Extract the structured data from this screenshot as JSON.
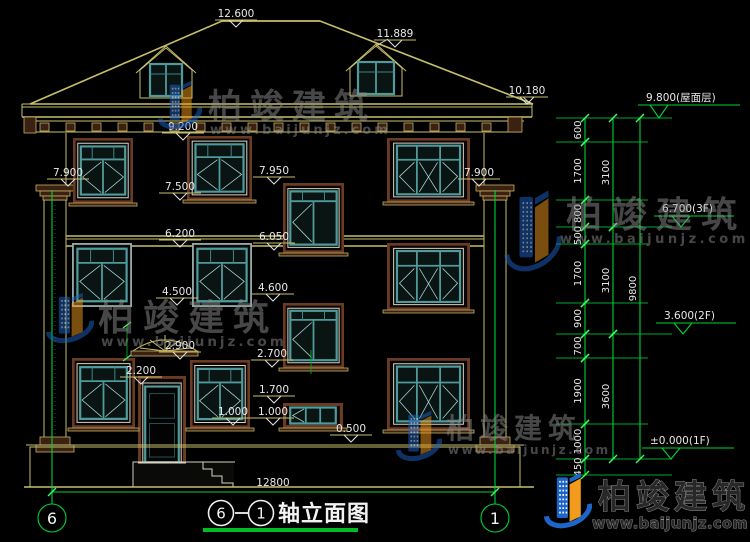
{
  "watermark": {
    "brand": "柏竣建筑",
    "url": "www.baijunjz.com"
  },
  "footer": {
    "brand": "柏竣建筑",
    "url": "www.baijunjz.com"
  },
  "title_block": {
    "from": "6",
    "to": "1",
    "title": "轴立面图"
  },
  "axes": {
    "left": "6",
    "right": "1"
  },
  "dims": {
    "total_width": "12800",
    "inner": [
      {
        "v": "600",
        "y1": 118,
        "y2": 142
      },
      {
        "v": "1700",
        "y1": 142,
        "y2": 200
      },
      {
        "v": "800",
        "y1": 200,
        "y2": 227
      },
      {
        "v": "500",
        "y1": 227,
        "y2": 244
      },
      {
        "v": "1700",
        "y1": 244,
        "y2": 303
      },
      {
        "v": "900",
        "y1": 303,
        "y2": 334
      },
      {
        "v": "700",
        "y1": 334,
        "y2": 358
      },
      {
        "v": "1900",
        "y1": 358,
        "y2": 424
      },
      {
        "v": "1000",
        "y1": 424,
        "y2": 459
      },
      {
        "v": "450",
        "y1": 459,
        "y2": 475
      }
    ],
    "mid": [
      {
        "v": "3100",
        "y1": 118,
        "y2": 227
      },
      {
        "v": "3100",
        "y1": 227,
        "y2": 334
      },
      {
        "v": "3600",
        "y1": 334,
        "y2": 459
      }
    ],
    "total": [
      {
        "v": "9800",
        "y1": 118,
        "y2": 459
      }
    ]
  },
  "levels": {
    "facade": [
      {
        "t": "12.600",
        "cx": 236,
        "ly": 20
      },
      {
        "t": "11.889",
        "cx": 395,
        "ly": 40
      },
      {
        "t": "10.180",
        "cx": 527,
        "ly": 97
      },
      {
        "t": "9.200",
        "cx": 183,
        "ly": 133
      },
      {
        "t": "7.900",
        "cx": 68,
        "ly": 179
      },
      {
        "t": "7.950",
        "cx": 274,
        "ly": 177
      },
      {
        "t": "7.900",
        "cx": 479,
        "ly": 179
      },
      {
        "t": "7.500",
        "cx": 180,
        "ly": 193
      },
      {
        "t": "6.200",
        "cx": 180,
        "ly": 240
      },
      {
        "t": "6.050",
        "cx": 274,
        "ly": 243
      },
      {
        "t": "4.500",
        "cx": 177,
        "ly": 298
      },
      {
        "t": "4.600",
        "cx": 273,
        "ly": 294
      },
      {
        "t": "2.900",
        "cx": 180,
        "ly": 352
      },
      {
        "t": "2.700",
        "cx": 272,
        "ly": 360
      },
      {
        "t": "2.200",
        "cx": 141,
        "ly": 377
      },
      {
        "t": "1.700",
        "cx": 274,
        "ly": 396
      },
      {
        "t": "1.000",
        "cx": 233,
        "ly": 418
      },
      {
        "t": "1.000",
        "cx": 273,
        "ly": 418
      },
      {
        "t": "0.500",
        "cx": 351,
        "ly": 435
      }
    ],
    "right": [
      {
        "t": "9.800(屋面层)",
        "x": 646,
        "ly": 105,
        "tx": 659,
        "ty": 118,
        "x2": 740
      },
      {
        "t": "6.700(3F)",
        "x": 662,
        "ly": 216,
        "tx": 681,
        "ty": 227,
        "x2": 734
      },
      {
        "t": "3.600(2F)",
        "x": 664,
        "ly": 323,
        "tx": 683,
        "ty": 334,
        "x2": 736
      },
      {
        "t": "±0.000(1F)",
        "x": 650,
        "ly": 448,
        "tx": 671,
        "ty": 459,
        "x2": 734
      }
    ]
  },
  "colors": {
    "line_yellow": "#c8bf6a",
    "window_teal": "#4f9a9a",
    "trim_brown": "#6b3a22",
    "dim_green": "#00d435",
    "text": "#e8e8e8",
    "logo_blue": "#1d65c9",
    "logo_orange": "#f29b1d",
    "title_bar_green": "#00bb22"
  }
}
